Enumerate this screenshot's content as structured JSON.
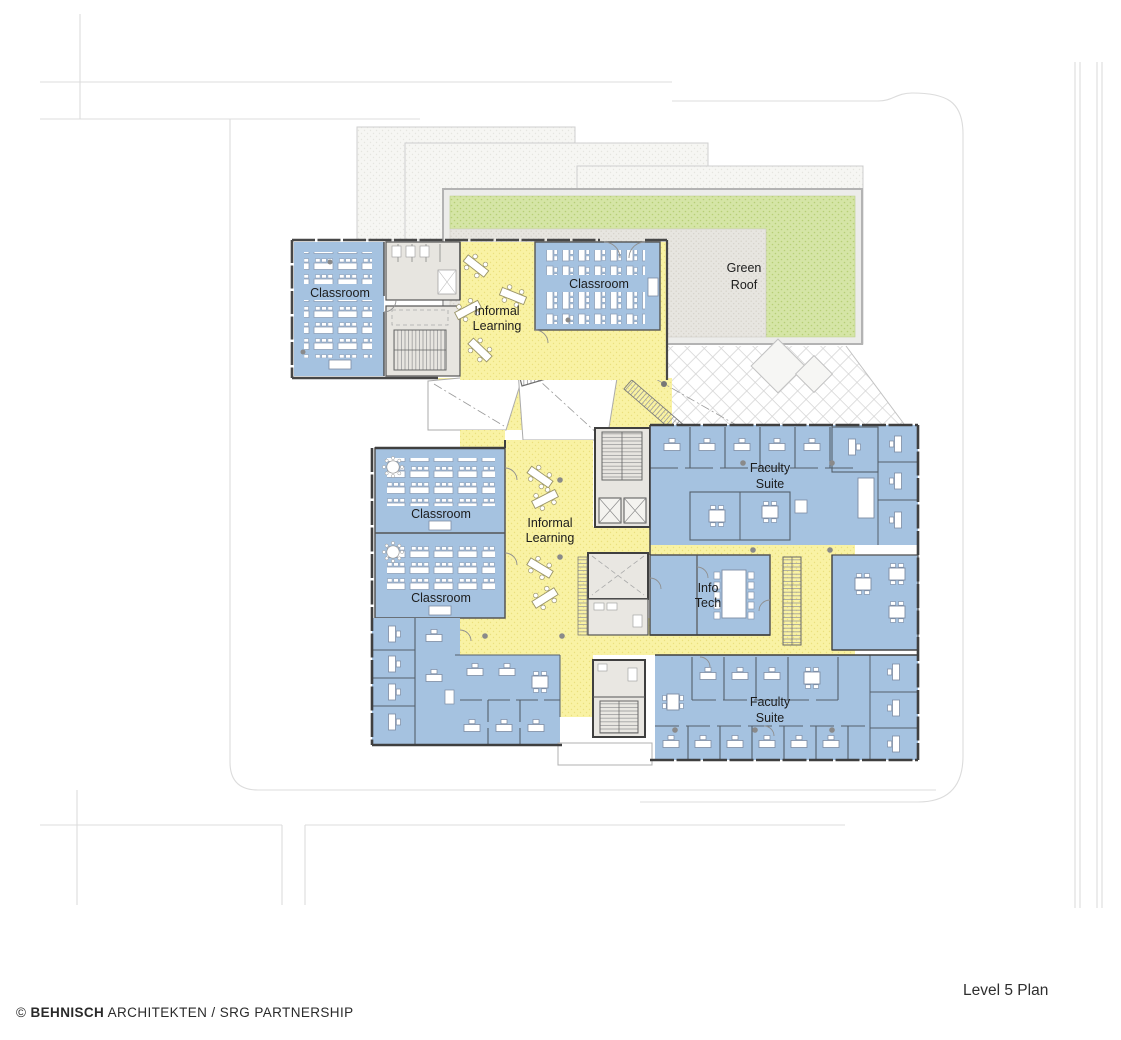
{
  "title": "Level 5 Plan",
  "credit": {
    "prefix": "© ",
    "firm": "BEHNISCH",
    "rest": " ARCHITEKTEN / SRG PARTNERSHIP"
  },
  "labels": {
    "classroom_upper_left": "Classroom",
    "classroom_upper_right": "Classroom",
    "informal_upper": {
      "line1": "Informal",
      "line2": "Learning"
    },
    "green_roof": {
      "line1": "Green",
      "line2": "Roof"
    },
    "classroom_mid_1": "Classroom",
    "classroom_mid_2": "Classroom",
    "informal_lower": {
      "line1": "Informal",
      "line2": "Learning"
    },
    "faculty_upper": {
      "line1": "Faculty",
      "line2": "Suite"
    },
    "info_tech": {
      "line1": "Info",
      "line2": "Tech"
    },
    "faculty_lower": {
      "line1": "Faculty",
      "line2": "Suite"
    }
  },
  "legend_colors": {
    "room_blue": "#a5c2e0",
    "circulation_yellow": "#f9f2a4",
    "green_roof_green": "#d5e5a6",
    "core_gray": "#e7e5e0",
    "wall": "#4a4a4a",
    "site_line": "#dcdcdc"
  }
}
